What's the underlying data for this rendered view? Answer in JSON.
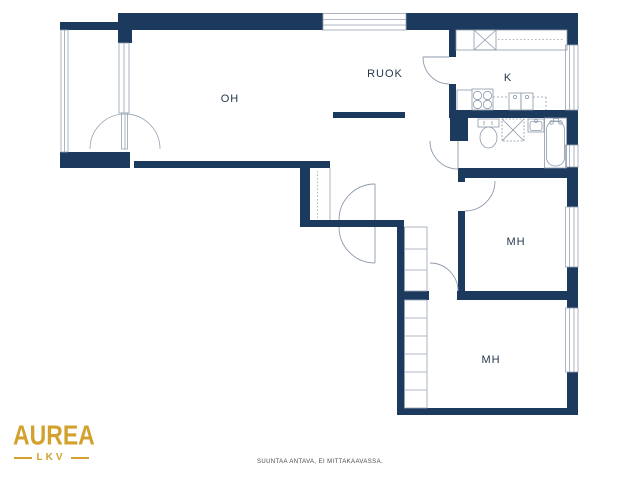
{
  "floor_plan": {
    "rooms": [
      {
        "id": "oh",
        "label": "OH"
      },
      {
        "id": "ruok",
        "label": "RUOK"
      },
      {
        "id": "k",
        "label": "K"
      },
      {
        "id": "mh1",
        "label": "MH"
      },
      {
        "id": "mh2",
        "label": "MH"
      }
    ]
  },
  "branding": {
    "logo_text": "AUREA",
    "logo_subtext": "LKV",
    "logo_color": "#D2A12E"
  },
  "footer": {
    "disclaimer": "SUUNTAA ANTAVA, EI MITTAKAAVASSA."
  },
  "colors": {
    "wall": "#1C3A5E",
    "thin_line": "#97A3B2",
    "background": "#FFFFFF"
  }
}
